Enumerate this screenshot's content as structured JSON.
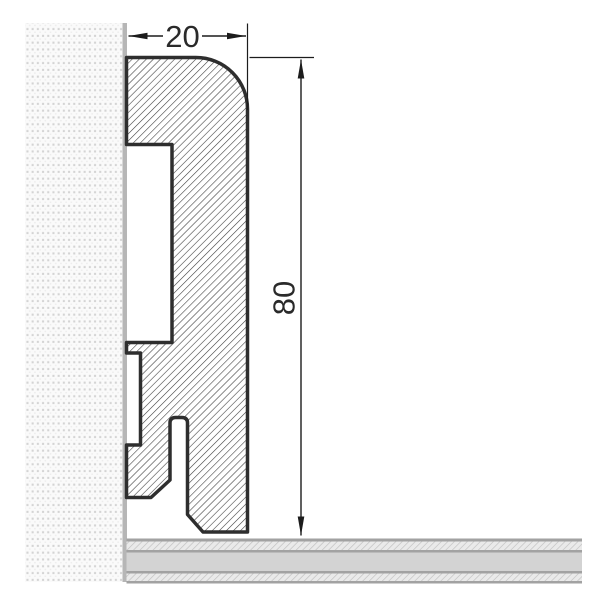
{
  "drawing": {
    "width_label": "20",
    "height_label": "80"
  },
  "colors": {
    "background": "#ffffff",
    "profile_outline": "#2e2e2e",
    "profile_hatch": "#3c3c3c",
    "dimension_line": "#1c1c1c",
    "dimension_text": "#2a2a2a",
    "wall_fill": "#fafafa",
    "wall_dot": "#d4d4d4",
    "wall_dot_faint": "#ececec",
    "wall_surface": "#b6b6b6",
    "floor_screed": "#d3d3d3",
    "floor_hatch_fill": "#eaeaea",
    "floor_hatch_line": "#c2c2c2",
    "floor_border": "#a2a2a2"
  }
}
